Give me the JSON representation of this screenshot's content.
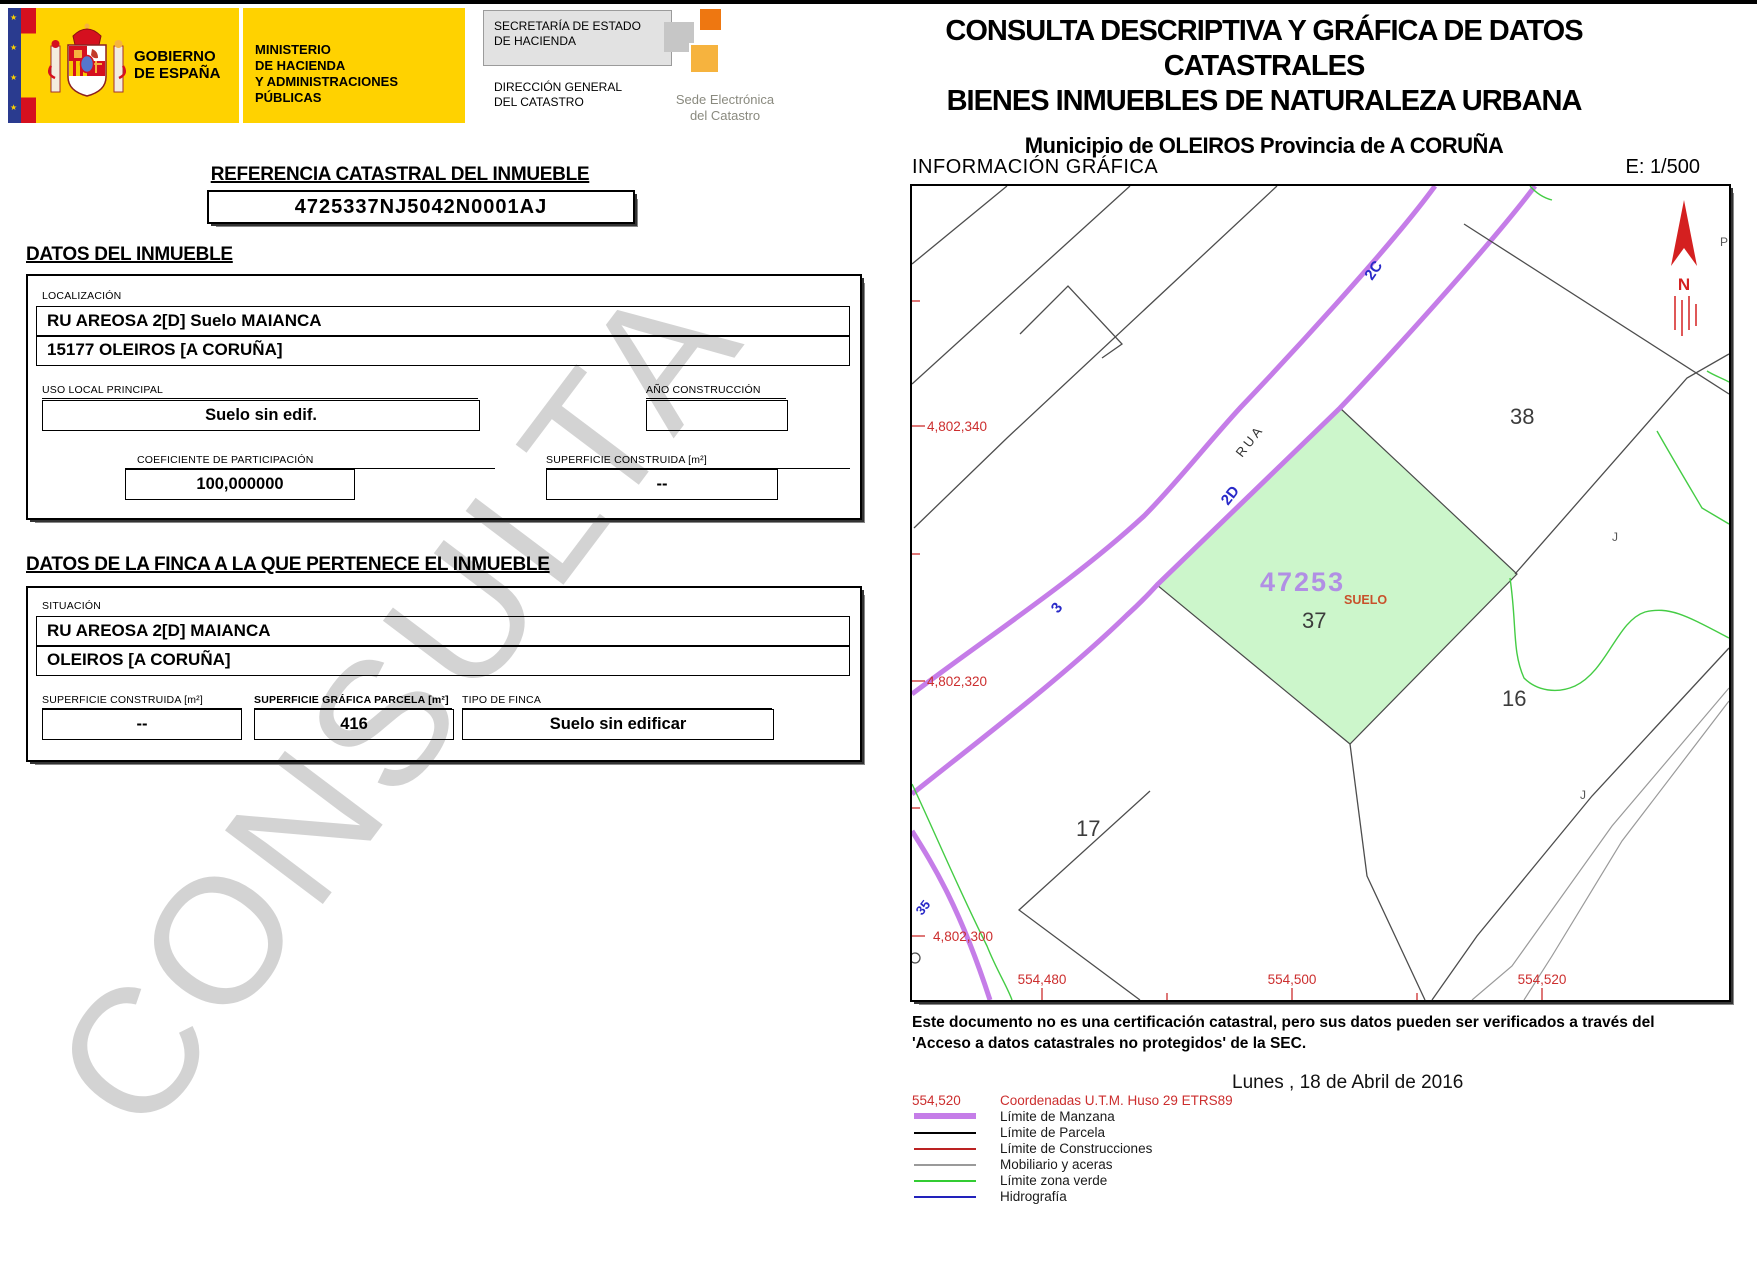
{
  "header": {
    "gobierno": "GOBIERNO\nDE ESPAÑA",
    "ministerio": "MINISTERIO\nDE HACIENDA\nY ADMINISTRACIONES PÚBLICAS",
    "secretaria": "SECRETARÍA DE ESTADO\nDE HACIENDA",
    "direccion": "DIRECCIÓN GENERAL\nDEL CATASTRO",
    "sede": "Sede Electrónica\ndel Catastro"
  },
  "title": {
    "line1": "CONSULTA DESCRIPTIVA Y GRÁFICA DE DATOS CATASTRALES",
    "line2": "BIENES INMUEBLES DE NATURALEZA URBANA",
    "line3": "Municipio de OLEIROS Provincia de A CORUÑA"
  },
  "referencia": {
    "heading": "REFERENCIA CATASTRAL DEL INMUEBLE",
    "value": "4725337NJ5042N0001AJ"
  },
  "inmueble": {
    "heading": "DATOS DEL INMUEBLE",
    "localizacion_label": "LOCALIZACIÓN",
    "localizacion_1": "RU AREOSA 2[D] Suelo MAIANCA",
    "localizacion_2": "15177 OLEIROS [A CORUÑA]",
    "uso_label": "USO LOCAL PRINCIPAL",
    "uso": "Suelo sin edif.",
    "ano_label": "AÑO CONSTRUCCIÓN",
    "ano": "",
    "coeficiente_label": "COEFICIENTE DE PARTICIPACIÓN",
    "coeficiente": "100,000000",
    "superficie_label": "SUPERFICIE CONSTRUIDA [m²]",
    "superficie": "--"
  },
  "finca": {
    "heading": "DATOS DE LA FINCA A LA QUE PERTENECE EL INMUEBLE",
    "situacion_label": "SITUACIÓN",
    "situacion_1": "RU AREOSA 2[D] MAIANCA",
    "situacion_2": "OLEIROS [A CORUÑA]",
    "sup_construida_label": "SUPERFICIE CONSTRUIDA [m²]",
    "sup_construida": "--",
    "sup_grafica_label": "SUPERFICIE GRÁFICA PARCELA [m²]",
    "sup_grafica": "416",
    "tipo_label": "TIPO DE FINCA",
    "tipo": "Suelo sin edificar"
  },
  "grafica": {
    "heading": "INFORMACIÓN GRÁFICA",
    "escala": "E: 1/500"
  },
  "map": {
    "utm_y": [
      "4,802,340",
      "4,802,320",
      "4,802,300"
    ],
    "utm_x": [
      "554,480",
      "554,500",
      "554,520"
    ],
    "parcel_number": "47253",
    "parcel_use": "SUELO",
    "parcels": {
      "p37": "37",
      "p38": "38",
      "p16": "16",
      "p17": "17"
    },
    "streets": {
      "rua": "RUA",
      "n2c": "2C",
      "n2d": "2D",
      "n3": "3",
      "n35": "35"
    },
    "letters": {
      "j1": "J",
      "j2": "J",
      "p": "P",
      "north": "N"
    }
  },
  "disclaimer": {
    "line1": "Este documento no es una certificación catastral, pero sus datos pueden ser verificados a través del",
    "line2": "'Acceso a datos catastrales no protegidos' de la SEC."
  },
  "legend": {
    "coord_sample": "554,520",
    "coord_label": "Coordenadas U.T.M. Huso 29 ETRS89",
    "items": [
      {
        "label": "Límite de Manzana",
        "color": "#c57de8"
      },
      {
        "label": "Límite de Parcela",
        "color": "#000000"
      },
      {
        "label": "Límite de Construcciones",
        "color": "#bb2222"
      },
      {
        "label": "Mobiliario y aceras",
        "color": "#9a9a9a"
      },
      {
        "label": "Límite zona verde",
        "color": "#33cc33"
      },
      {
        "label": "Hidrografía",
        "color": "#2222bb"
      }
    ]
  },
  "date": "Lunes , 18 de Abril de 2016",
  "watermark": "CONSULTA",
  "colors": {
    "accent_yellow": "#ffd200",
    "manzana_purple": "#c57de8",
    "parcel_fill": "#ccf6cb",
    "coord_red": "#cc2e2e",
    "ref_purple": "#b18fe4",
    "suelo_red": "#c8512b",
    "street_blue": "#2929c8"
  }
}
